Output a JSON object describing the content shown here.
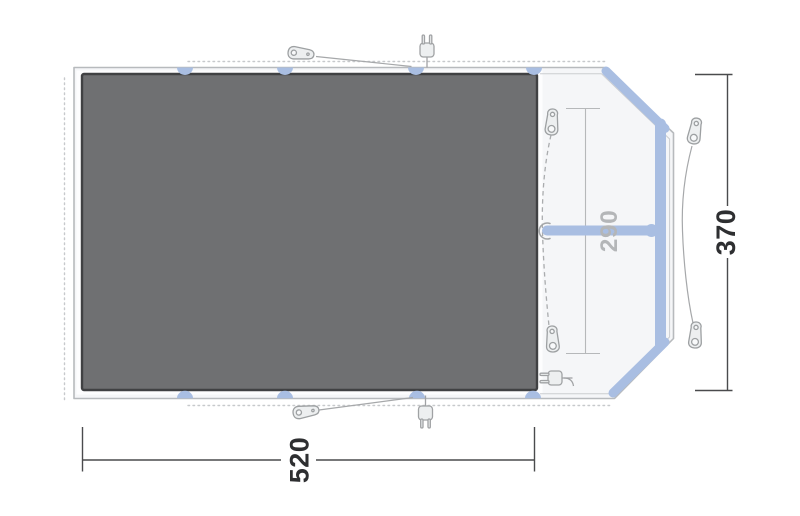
{
  "diagram": {
    "name": "tent-floorplan-top-view",
    "labels": {
      "total_width": "520",
      "total_depth": "370",
      "inner_depth": "290"
    },
    "colors": {
      "pole_accent": "#a9bee2",
      "pole_accent_edge": "#93abd8",
      "groundsheet_fill": "#6f7072",
      "groundsheet_border": "#404143",
      "tent_fill": "#f5f6f8",
      "tent_outline": "#b7babd",
      "dotted_outline": "#c7c9cc",
      "icon_stroke": "#9da0a2",
      "icon_fill": "#edeff0",
      "guy_line": "#a6a8aa",
      "primary_dimension_line": "#4a4b4d",
      "primary_dimension_text": "#2e2f31",
      "secondary_dimension_line": "#b6b8ba",
      "secondary_dimension_text": "#b4b6b8"
    },
    "icon_names": [
      "power-plug-icon",
      "guy-line-peg-icon",
      "toggle-peg-icon"
    ]
  }
}
